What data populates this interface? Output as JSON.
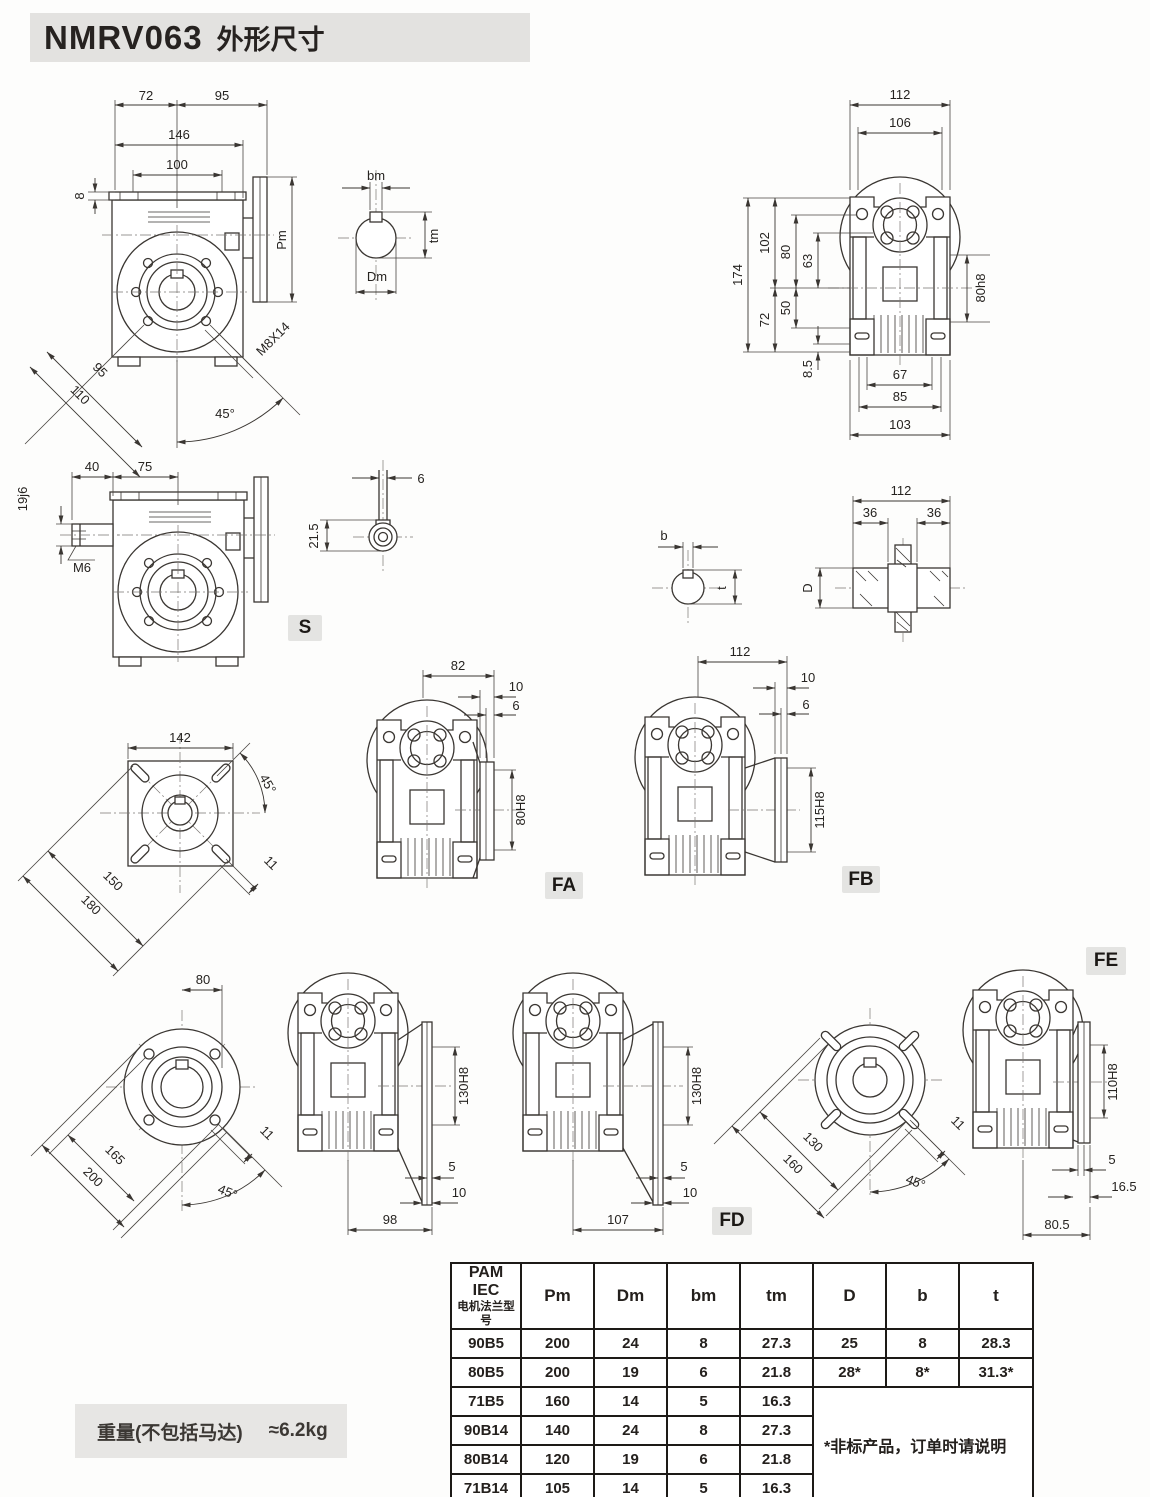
{
  "page": {
    "title_model": "NMRV063",
    "title_text": "外形尺寸"
  },
  "badges": {
    "s": "S",
    "fa": "FA",
    "fb": "FB",
    "fd": "FD",
    "fe": "FE"
  },
  "front_view": {
    "d72": "72",
    "d95": "95",
    "d146": "146",
    "d100": "100",
    "d8": "8",
    "pm": "Pm",
    "diag95": "95",
    "diag110": "110",
    "angle45": "45°",
    "m8x14": "M8X14"
  },
  "shaft_detail": {
    "bm": "bm",
    "tm": "tm",
    "dm": "Dm"
  },
  "rear_view": {
    "d112": "112",
    "d106": "106",
    "d174": "174",
    "d102": "102",
    "d80": "80",
    "d63": "63",
    "d72": "72",
    "d50": "50",
    "d8_5": "8.5",
    "d80h8": "80h8",
    "d67": "67",
    "d85": "85",
    "d103": "103"
  },
  "s_view": {
    "d40": "40",
    "d75": "75",
    "d19j6": "19j6",
    "m6": "M6"
  },
  "s_detail": {
    "d6": "6",
    "d21_5": "21.5"
  },
  "bt_detail": {
    "b": "b",
    "t": "t"
  },
  "hollow_shaft": {
    "d112": "112",
    "d36a": "36",
    "d36b": "36",
    "dd": "D"
  },
  "square_flange": {
    "d142": "142",
    "angle45": "45°",
    "d150": "150",
    "d180": "180",
    "d11": "11"
  },
  "fa_view": {
    "d82": "82",
    "d10": "10",
    "d6": "6",
    "bore": "80H8"
  },
  "fb_view": {
    "d112": "112",
    "d10": "10",
    "d6": "6",
    "bore": "115H8"
  },
  "round_flange_a": {
    "d80": "80",
    "d165": "165",
    "d200": "200",
    "d11": "11",
    "angle45": "45°"
  },
  "fd1_view": {
    "bore": "130H8",
    "d5": "5",
    "d10": "10",
    "d98": "98"
  },
  "fd2_view": {
    "bore": "130H8",
    "d5": "5",
    "d10": "10",
    "d107": "107"
  },
  "round_flange_b": {
    "d130": "130",
    "d160": "160",
    "d11": "11",
    "angle45": "45°"
  },
  "fe_view": {
    "bore": "110H8",
    "d5": "5",
    "d16_5": "16.5",
    "d80_5": "80.5"
  },
  "table": {
    "header_col1_line1": "PAM IEC",
    "header_col1_line2": "电机法兰型号",
    "headers": [
      "Pm",
      "Dm",
      "bm",
      "tm",
      "D",
      "b",
      "t"
    ],
    "rows": [
      [
        "90B5",
        "200",
        "24",
        "8",
        "27.3",
        "25",
        "8",
        "28.3"
      ],
      [
        "80B5",
        "200",
        "19",
        "6",
        "21.8",
        "28*",
        "8*",
        "31.3*"
      ],
      [
        "71B5",
        "160",
        "14",
        "5",
        "16.3"
      ],
      [
        "90B14",
        "140",
        "24",
        "8",
        "27.3"
      ],
      [
        "80B14",
        "120",
        "19",
        "6",
        "21.8"
      ],
      [
        "71B14",
        "105",
        "14",
        "5",
        "16.3"
      ]
    ],
    "note": "*非标产品，订单时请说明"
  },
  "weight": {
    "label": "重量(不包括马达)",
    "value": "≈6.2kg"
  }
}
